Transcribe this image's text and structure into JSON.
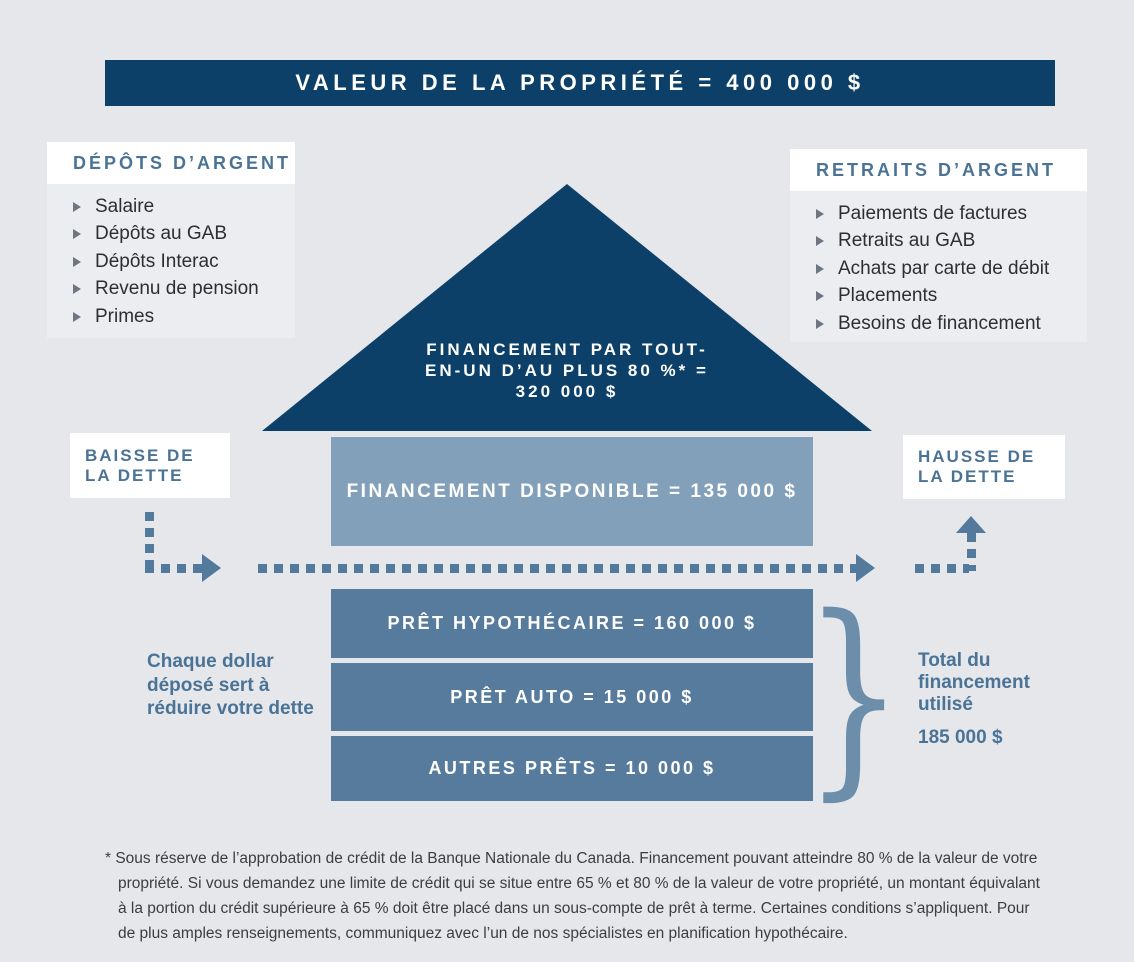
{
  "title_banner": {
    "text": "VALEUR DE LA PROPRIÉTÉ = 400 000 $"
  },
  "deposits_box": {
    "title": "DÉPÔTS D’ARGENT",
    "items": [
      "Salaire",
      "Dépôts au GAB",
      "Dépôts Interac",
      "Revenu de pension",
      "Primes"
    ]
  },
  "withdrawals_box": {
    "title": "RETRAITS D’ARGENT",
    "items": [
      "Paiements de factures",
      "Retraits au GAB",
      "Achats par carte de débit",
      "Placements",
      "Besoins de financement"
    ]
  },
  "roof": {
    "lines": [
      "FINANCEMENT PAR TOUT-",
      "EN-UN D’AU PLUS 80 %* =",
      "320 000 $"
    ]
  },
  "available_bar": {
    "text": "FINANCEMENT DISPONIBLE = 135 000 $"
  },
  "debt_decrease_label": {
    "line1": "BAISSE DE",
    "line2": "LA DETTE"
  },
  "debt_increase_label": {
    "line1": "HAUSSE DE",
    "line2": "LA DETTE"
  },
  "loan_bars": [
    "PRÊT HYPOTHÉCAIRE = 160 000 $",
    "PRÊT AUTO = 15 000 $",
    "AUTRES PRÊTS = 10 000 $"
  ],
  "left_note": {
    "lines": [
      "Chaque dollar",
      "déposé sert à",
      "réduire votre dette"
    ]
  },
  "total_note": {
    "lines": [
      "Total du",
      "financement",
      "utilisé"
    ],
    "amount": "185 000 $",
    "brace_glyph": "}"
  },
  "footnote": "* Sous réserve de l’approbation de crédit de la Banque Nationale du Canada. Financement pouvant atteindre 80 % de la valeur de votre propriété. Si vous demandez une limite de crédit qui se situe entre 65 % et 80 % de la valeur de votre propriété, un montant équivalant à la portion du crédit supérieure à 65 % doit être placé dans un sous-compte de prêt à terme. Certaines conditions s’appliquent. Pour de plus amples renseignements, communiquez avec l’un de nos spécialistes en planification hypothécaire.",
  "colors": {
    "page_bg": "#e5e7eb",
    "navy": "#0d4068",
    "available_bar": "#82a0ba",
    "loan_bar": "#567b9d",
    "steel_text": "#4a7396",
    "arrow": "#537a9c",
    "brace": "#6d8eab"
  }
}
